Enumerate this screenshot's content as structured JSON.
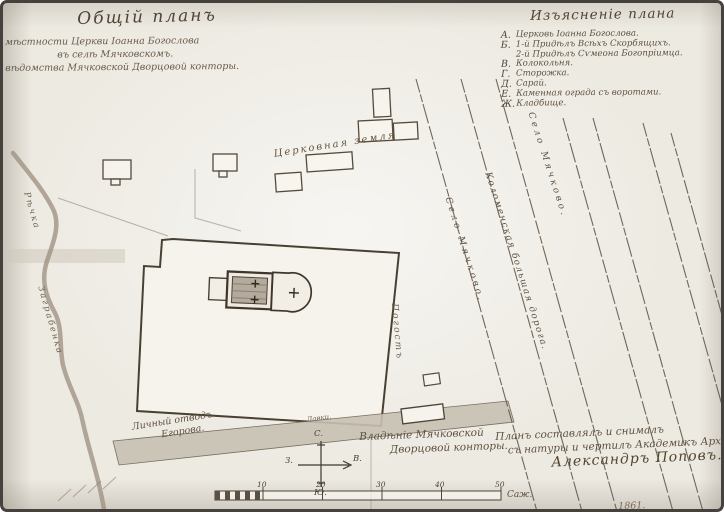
{
  "document": {
    "title": "Общій планъ",
    "subtitle_lines": {
      "l1": "мѣстности Церкви Іоанна Богослова",
      "l2": "въ селѣ Мячковскомъ.",
      "l3": "вѣдомства Мячковской Дворцовой конторы."
    }
  },
  "legend": {
    "title": "Изъясненіе плана",
    "items": [
      {
        "key": "А.",
        "label": "Церковь Іоанна Богослова."
      },
      {
        "key": "Б.",
        "label": "1-й Придѣлъ Всѣхъ Скорбящихъ."
      },
      {
        "key": "",
        "label": "2-й Придѣлъ Сѵмеона Богопріимца."
      },
      {
        "key": "В.",
        "label": "Колокольня."
      },
      {
        "key": "Г.",
        "label": "Сторожка."
      },
      {
        "key": "Д.",
        "label": "Сарай."
      },
      {
        "key": "Е.",
        "label": "Каменная ограда съ воротами."
      },
      {
        "key": "Ж.",
        "label": "Кладбище."
      }
    ]
  },
  "map_labels": {
    "church_land": "Церковная земля",
    "river_upper": "Рѣчка",
    "river_lower": "Заграбенка",
    "churchyard": "Погостъ",
    "road_1": "Село Мячково.",
    "road_2": "Коломенская большая дорога.",
    "road_3": "Село Мячково.",
    "shop": "Лавки.",
    "private_plot_l1": "Личный отводъ",
    "private_plot_l2": "Егорова.",
    "ownership_l1": "Владѣніе Мячковской",
    "ownership_l2": "Дворцовой конторы."
  },
  "compass": {
    "north": "С.",
    "south": "Ю.",
    "west": "З.",
    "east": "В."
  },
  "scale_bar": {
    "numbers": [
      "10",
      "20",
      "30",
      "40",
      "50"
    ],
    "unit": "Саж."
  },
  "attribution": {
    "l1": "Планъ составлялъ и снималъ",
    "l2": "съ натуры и чертилъ Академикъ Архитектуры",
    "l3": "Александръ Поповъ.",
    "date": "1861."
  }
}
